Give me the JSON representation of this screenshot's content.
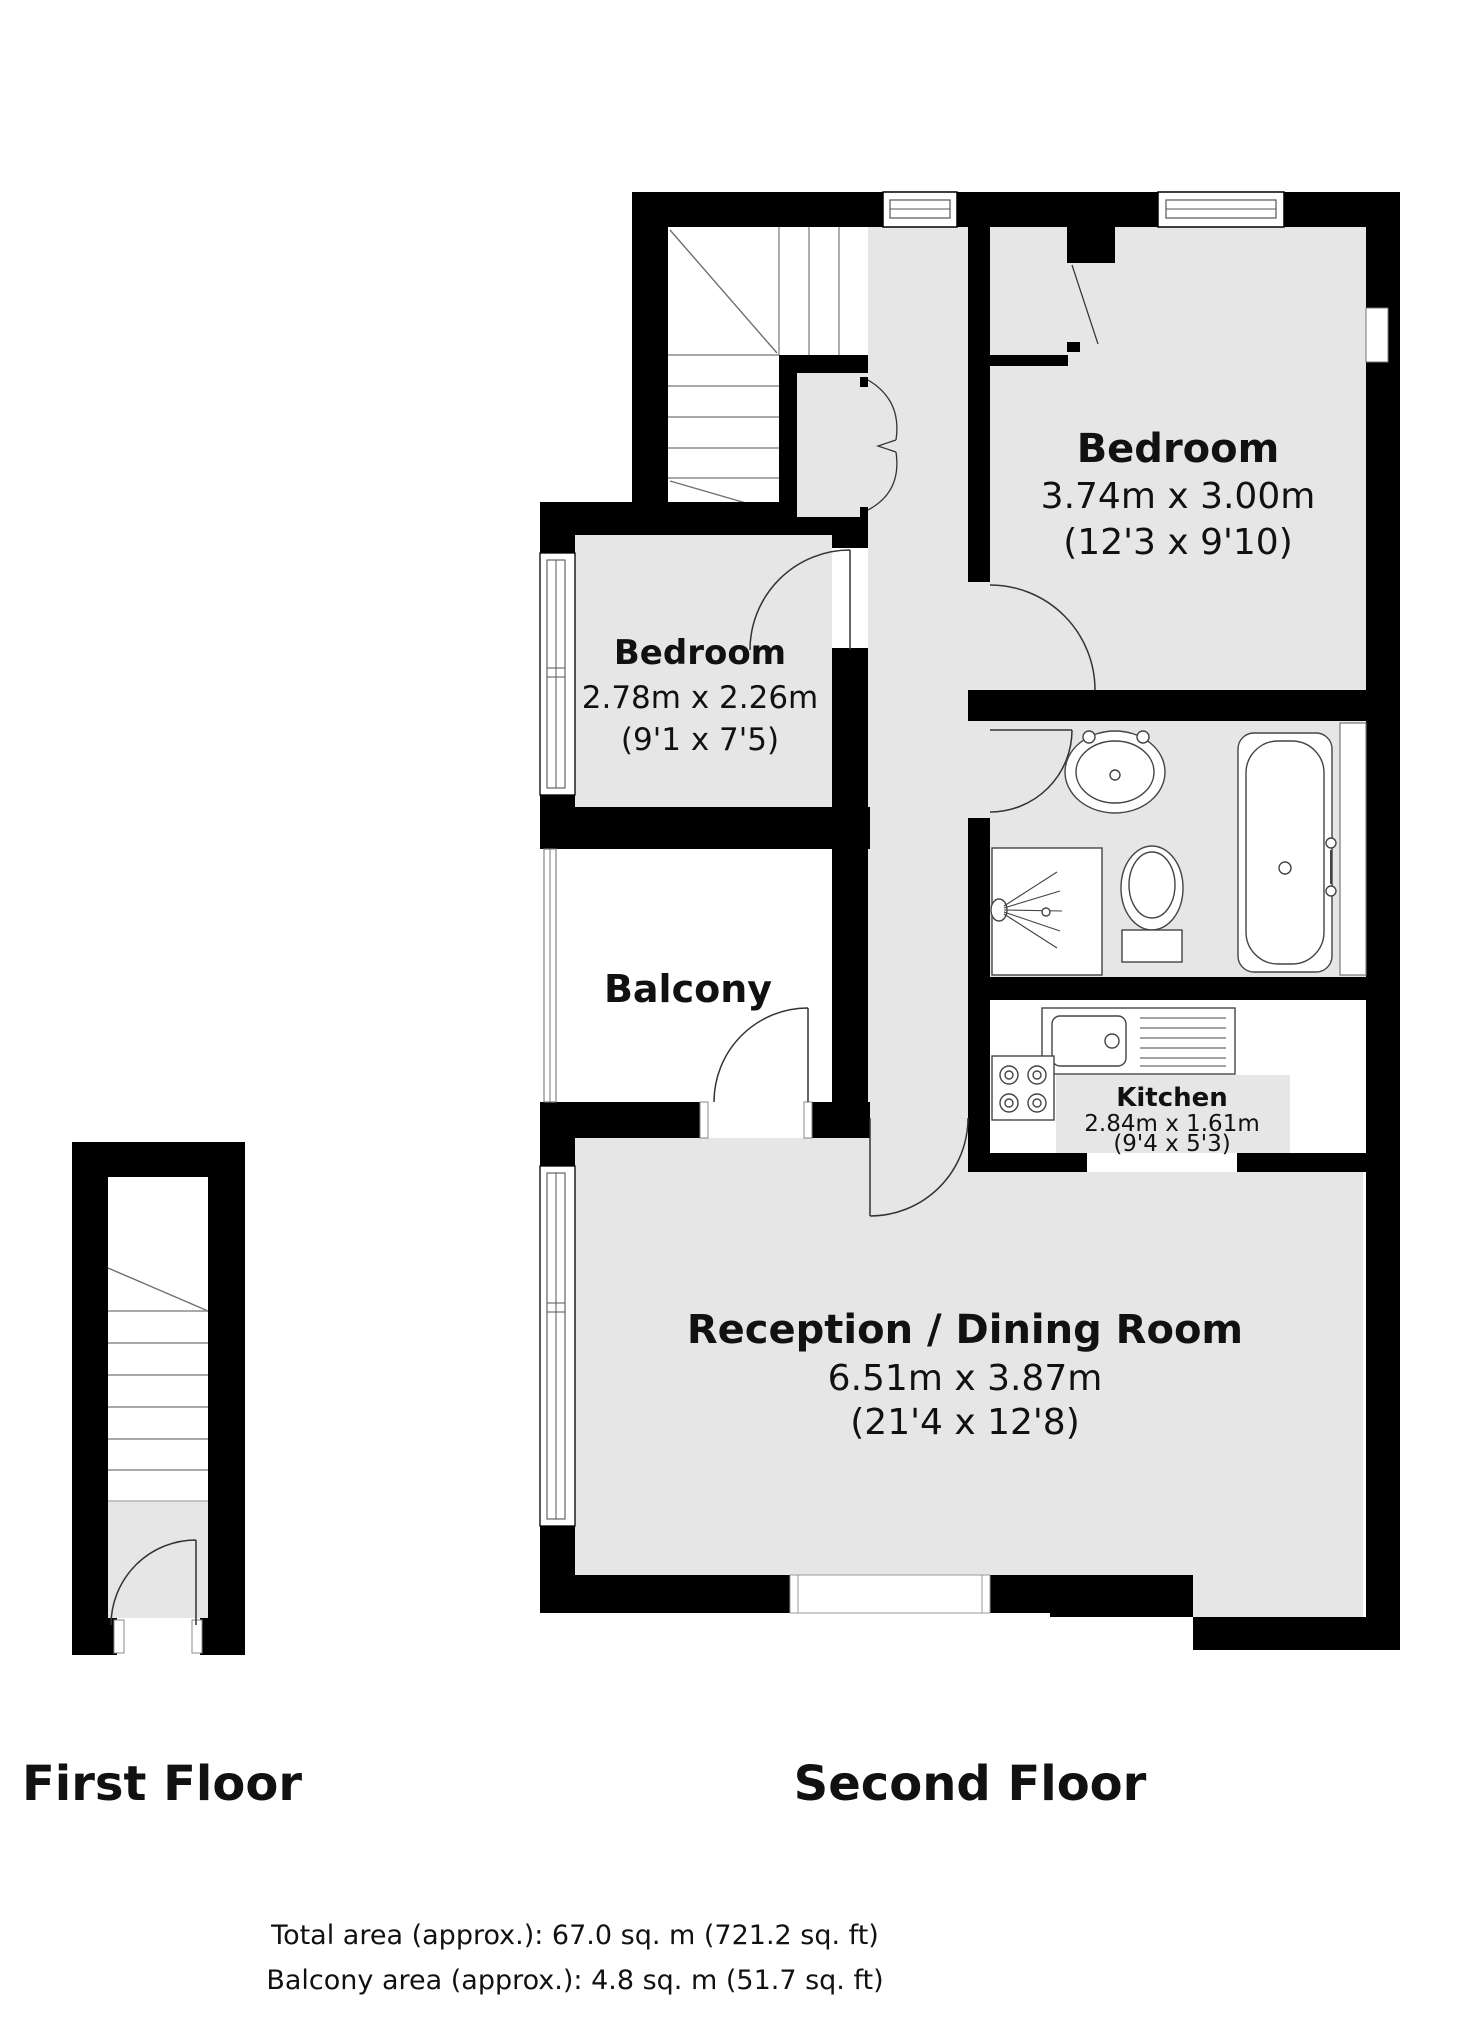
{
  "floors": {
    "first": {
      "label": "First Floor"
    },
    "second": {
      "label": "Second Floor"
    }
  },
  "rooms": {
    "bedroom_main": {
      "name": "Bedroom",
      "metric": "3.74m x 3.00m",
      "imperial": "(12'3 x 9'10)"
    },
    "bedroom_second": {
      "name": "Bedroom",
      "metric": "2.78m x 2.26m",
      "imperial": "(9'1 x 7'5)"
    },
    "balcony": {
      "name": "Balcony"
    },
    "kitchen": {
      "name": "Kitchen",
      "metric": "2.84m x 1.61m",
      "imperial": "(9'4 x 5'3)"
    },
    "reception": {
      "name": "Reception / Dining Room",
      "metric": "6.51m x 3.87m",
      "imperial": "(21'4 x 12'8)"
    }
  },
  "footer": {
    "total_area": "Total area (approx.): 67.0 sq. m (721.2 sq. ft)",
    "balcony_area": "Balcony area (approx.): 4.8 sq. m (51.7 sq. ft)"
  },
  "colors": {
    "wall": "#000000",
    "floor": "#e6e6e6",
    "line": "#4d4d4d"
  }
}
